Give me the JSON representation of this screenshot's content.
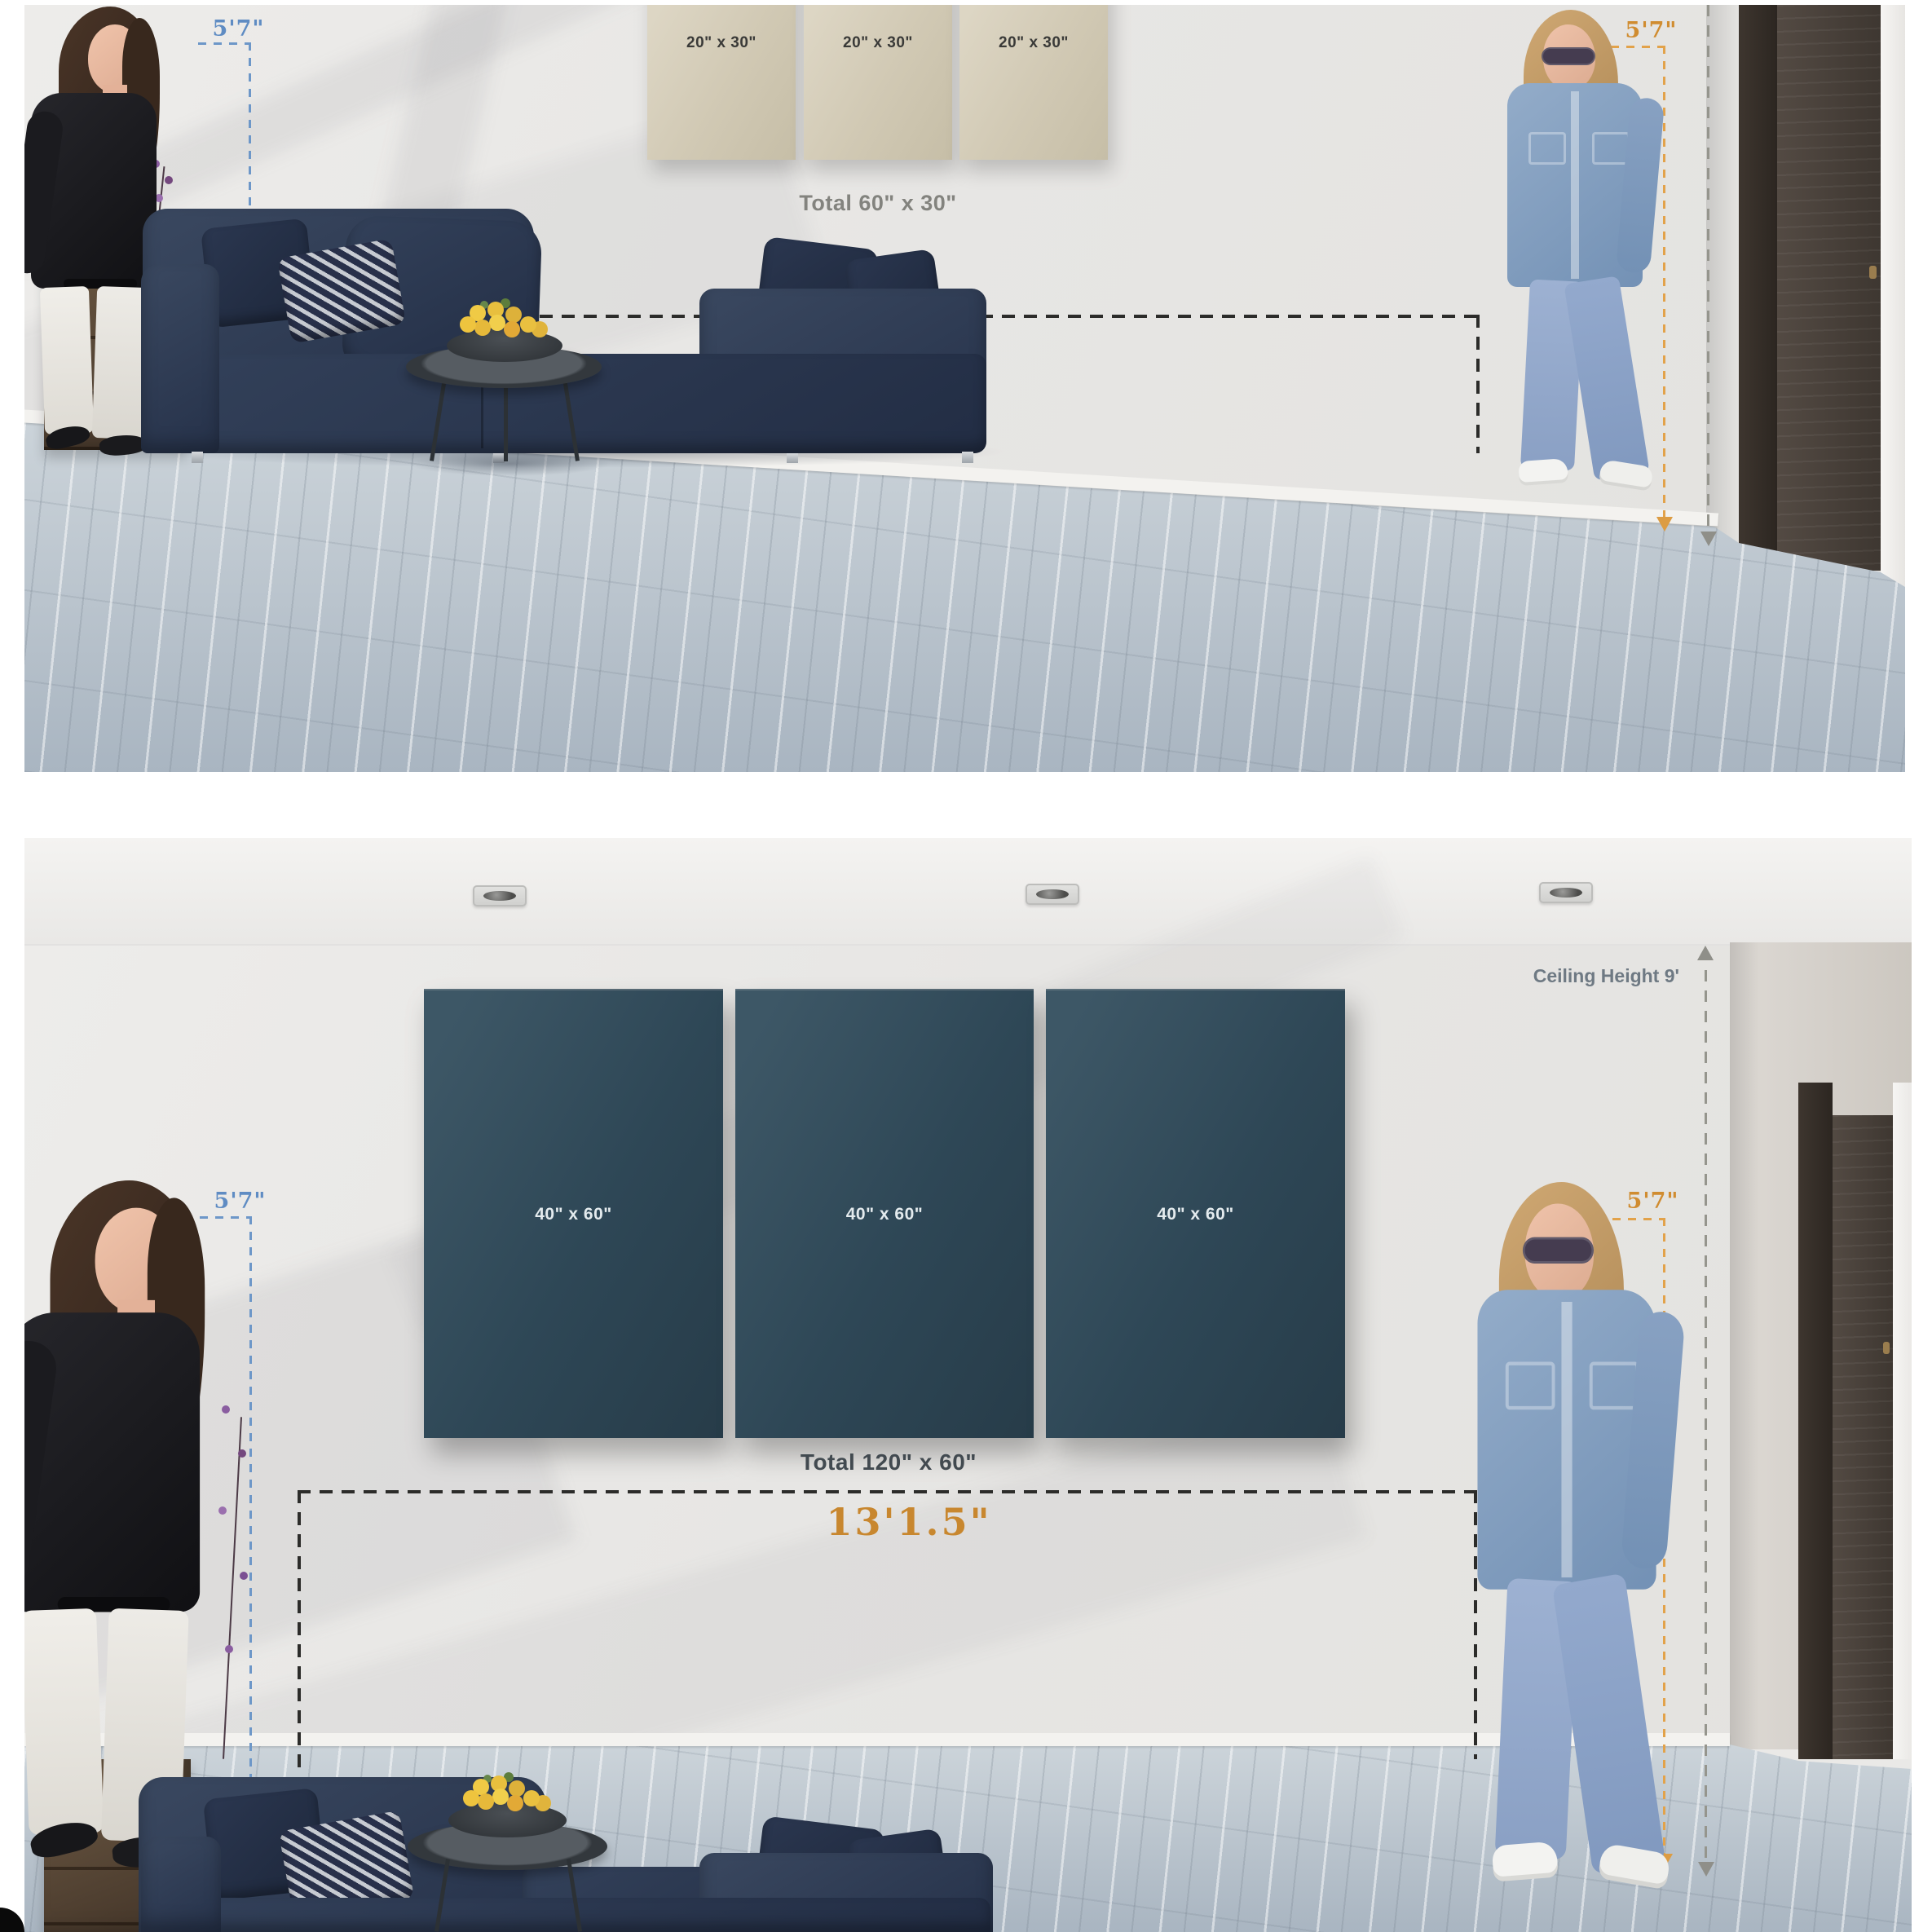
{
  "divider": {
    "title": "TOTAL 120\" x 60\""
  },
  "top_panel": {
    "canvas_labels": [
      "20\" x 30\"",
      "20\" x 30\"",
      "20\" x 30\""
    ],
    "total_label": "Total 60\" x 30\"",
    "sofa_width_label": "13'1.5\"",
    "person_height_left": "5'7\"",
    "person_height_right": "5'7\""
  },
  "bottom_panel": {
    "ceiling_label": "Ceiling Height 9'",
    "canvas_labels": [
      "40\" x 60\"",
      "40\" x 60\"",
      "40\" x 60\""
    ],
    "total_label": "Total 120\" x 60\"",
    "sofa_width_label": "13'1.5\"",
    "person_height_left": "5'7\"",
    "person_height_right": "5'7\""
  },
  "colors": {
    "measure_orange": "#cf8931",
    "measure_blue": "#5f8cc3",
    "canvas_beige": "#d1c9b4",
    "canvas_teal": "#2e4756",
    "sofa_navy": "#2e3c53",
    "divider_text": "#0c0c0c"
  }
}
